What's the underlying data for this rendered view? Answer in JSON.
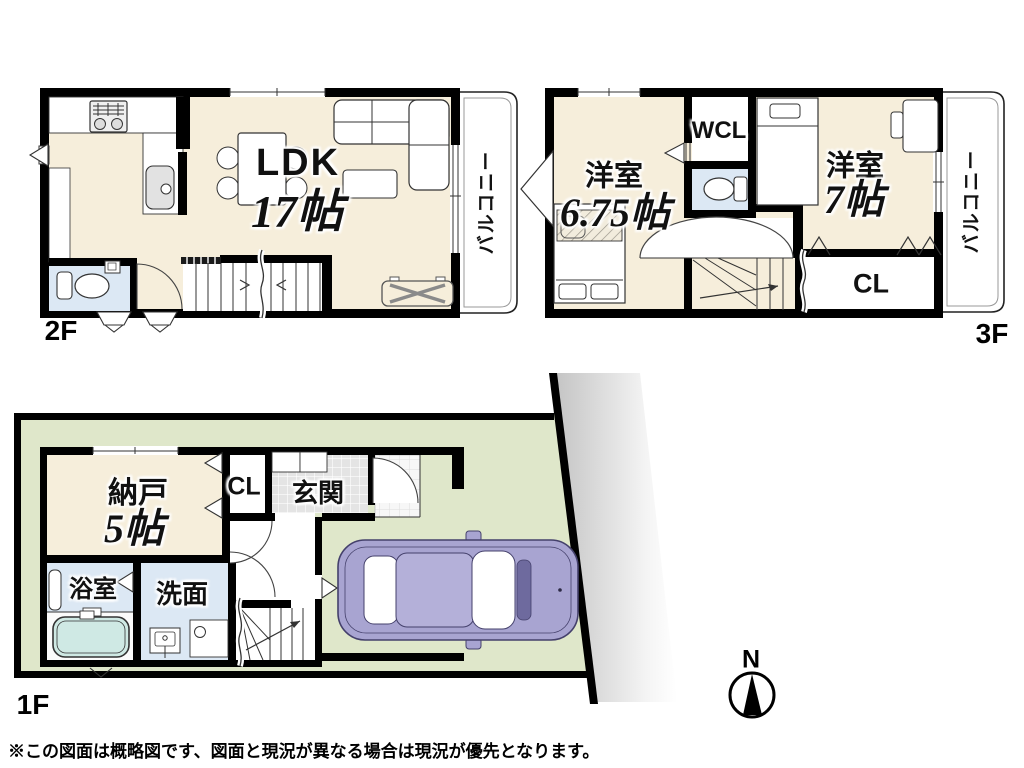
{
  "floor2": {
    "label": "2F",
    "ldk": "LDK",
    "ldk_size": "17帖",
    "balcony": "バルコニー"
  },
  "floor3": {
    "label": "3F",
    "west_room1": "洋室",
    "west_room1_size": "6.75帖",
    "west_room2": "洋室",
    "west_room2_size": "7帖",
    "wcl": "WCL",
    "closet": "CL",
    "balcony": "バルコニー"
  },
  "floor1": {
    "label": "1F",
    "storage": "納戸",
    "storage_size": "5帖",
    "closet": "CL",
    "entrance": "玄関",
    "bathroom": "浴室",
    "washroom": "洗面"
  },
  "compass": {
    "north_label": "N"
  },
  "footer": {
    "disclaimer": "※この図面は概略図です、図面と現況が異なる場合は現況が優先となります。"
  },
  "colors": {
    "wall": "#000000",
    "line": "#333333",
    "room_cream": "#f6eedb",
    "room_blue": "#dce8f4",
    "lot_green": "#dfe7ca",
    "tub_cyan": "#cfe9e4",
    "car_purple": "#a8a4d1",
    "car_roof": "#b4b0d9",
    "tile_gray": "#e4e4e4"
  }
}
